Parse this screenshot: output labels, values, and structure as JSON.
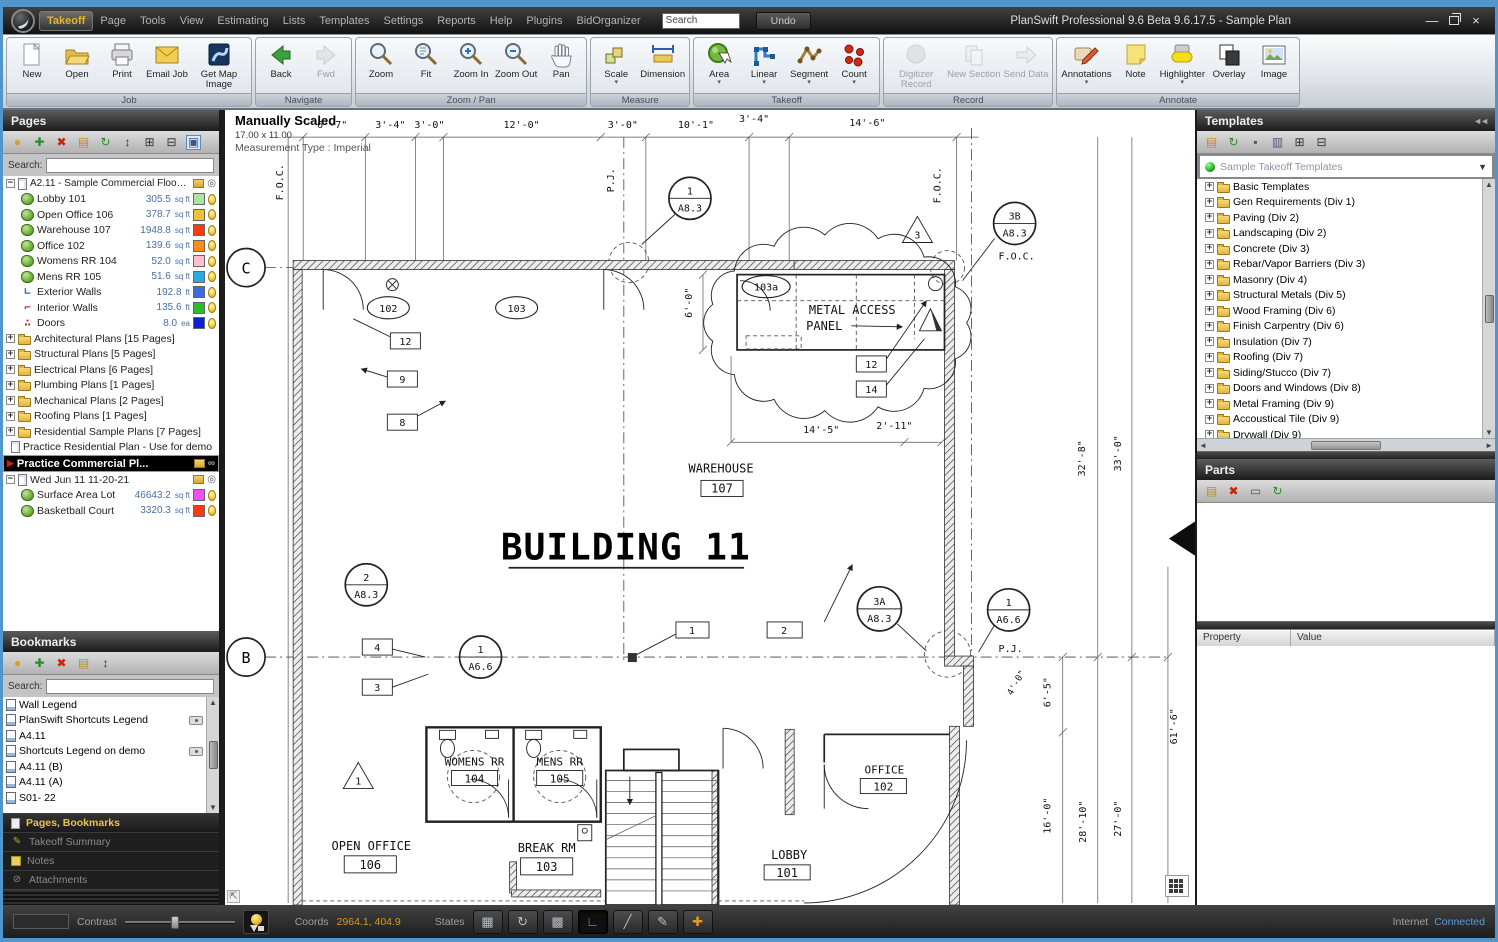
{
  "colors": {
    "accent_blue": "#4e96cc",
    "menu_gold": "#e5b42e",
    "coords_yellow": "#d89a1e",
    "connected_blue": "#5a9ae0"
  },
  "titlebar": {
    "menus": [
      "Takeoff",
      "Page",
      "Tools",
      "View",
      "Estimating",
      "Lists",
      "Templates",
      "Settings",
      "Reports",
      "Help",
      "Plugins",
      "BidOrganizer"
    ],
    "search_value": "Search",
    "undo": "Undo",
    "title": "PlanSwift Professional 9.6 Beta  9.6.17.5 - Sample Plan"
  },
  "ribbon": {
    "groups": [
      {
        "label": "Job",
        "buttons": [
          {
            "label": "New",
            "icon": "new-document-icon"
          },
          {
            "label": "Open",
            "icon": "open-folder-icon"
          },
          {
            "label": "Print",
            "icon": "print-icon"
          },
          {
            "label": "Email Job",
            "icon": "email-job-icon"
          },
          {
            "label": "Get Map Image",
            "icon": "get-map-image-icon"
          }
        ]
      },
      {
        "label": "Navigate",
        "buttons": [
          {
            "label": "Back",
            "icon": "back-icon"
          },
          {
            "label": "Fwd",
            "icon": "fwd-icon",
            "disabled": true
          }
        ]
      },
      {
        "label": "Zoom / Pan",
        "buttons": [
          {
            "label": "Zoom",
            "icon": "zoom-icon"
          },
          {
            "label": "Fit",
            "icon": "fit-icon"
          },
          {
            "label": "Zoom In",
            "icon": "zoom-in-icon"
          },
          {
            "label": "Zoom Out",
            "icon": "zoom-out-icon"
          },
          {
            "label": "Pan",
            "icon": "pan-icon"
          }
        ]
      },
      {
        "label": "Measure",
        "buttons": [
          {
            "label": "Scale",
            "icon": "scale-icon",
            "caret": true
          },
          {
            "label": "Dimension",
            "icon": "dimension-icon"
          }
        ]
      },
      {
        "label": "Takeoff",
        "buttons": [
          {
            "label": "Area",
            "icon": "area-icon",
            "caret": true
          },
          {
            "label": "Linear",
            "icon": "linear-icon",
            "caret": true
          },
          {
            "label": "Segment",
            "icon": "segment-icon",
            "caret": true
          },
          {
            "label": "Count",
            "icon": "count-icon",
            "caret": true
          }
        ]
      },
      {
        "label": "Record",
        "buttons": [
          {
            "label": "Digitizer Record",
            "icon": "digitizer-record-icon",
            "disabled": true
          },
          {
            "label": "New Section",
            "icon": "new-section-icon",
            "disabled": true
          },
          {
            "label": "Send Data",
            "icon": "send-data-icon",
            "disabled": true
          }
        ]
      },
      {
        "label": "Annotate",
        "buttons": [
          {
            "label": "Annotations",
            "icon": "annotations-icon",
            "caret": true
          },
          {
            "label": "Note",
            "icon": "note-icon"
          },
          {
            "label": "Highlighter",
            "icon": "highlighter-icon",
            "caret": true
          },
          {
            "label": "Overlay",
            "icon": "overlay-icon"
          },
          {
            "label": "Image",
            "icon": "image-icon"
          }
        ]
      }
    ]
  },
  "pages_panel": {
    "title": "Pages",
    "search_label": "Search:",
    "toolbar_icons": [
      "pin-icon",
      "add-icon",
      "delete-icon",
      "properties-icon",
      "refresh-icon",
      "sort-icon",
      "expand-all-icon",
      "collapse-all-icon",
      "panel-view-icon"
    ],
    "root_label": "A2.11 - Sample Commercial Floor Pl...",
    "takeoffs": [
      {
        "label": "Lobby 101",
        "value": "305.5",
        "unit": "sq ft",
        "color": "#abe49c",
        "icon": "area"
      },
      {
        "label": "Open Office 106",
        "value": "378.7",
        "unit": "sq ft",
        "color": "#f0c03a",
        "icon": "area"
      },
      {
        "label": "Warehouse 107",
        "value": "1948.8",
        "unit": "sq ft",
        "color": "#f93a10",
        "icon": "area"
      },
      {
        "label": "Office 102",
        "value": "139.6",
        "unit": "sq ft",
        "color": "#fb8c1e",
        "icon": "area"
      },
      {
        "label": "Womens RR 104",
        "value": "52.0",
        "unit": "sq ft",
        "color": "#ffc0cd",
        "icon": "area"
      },
      {
        "label": "Mens RR 105",
        "value": "51.6",
        "unit": "sq ft",
        "color": "#2eaae2",
        "icon": "area"
      },
      {
        "label": "Exterior Walls",
        "value": "192.8",
        "unit": "ft",
        "color": "#3d6be0",
        "icon": "linear-ext"
      },
      {
        "label": "Interior Walls",
        "value": "135.6",
        "unit": "ft",
        "color": "#2fbb2f",
        "icon": "linear-int"
      },
      {
        "label": "Doors",
        "value": "8.0",
        "unit": "ea",
        "color": "#1020d0",
        "icon": "count"
      }
    ],
    "folders": [
      "Architectural Plans [15 Pages]",
      "Structural Plans [5 Pages]",
      "Electrical Plans [6 Pages]",
      "Plumbing Plans [1 Pages]",
      "Mechanical Plans [2 Pages]",
      "Roofing Plans [1 Pages]",
      "Residential Sample Plans [7 Pages]"
    ],
    "practice_residential": "Practice Residential Plan - Use for demo",
    "selected_page": "Practice Commercial Pl...",
    "dated_page": "Wed Jun 11 11-20-21",
    "dated_takeoffs": [
      {
        "label": "Surface Area Lot",
        "value": "46643.2",
        "unit": "sq ft",
        "color": "#f24df2",
        "icon": "area"
      },
      {
        "label": "Basketball Court",
        "value": "3320.3",
        "unit": "sq ft",
        "color": "#f93a10",
        "icon": "area"
      }
    ]
  },
  "bookmarks_panel": {
    "title": "Bookmarks",
    "search_label": "Search:",
    "toolbar_icons": [
      "pin-icon",
      "add-icon",
      "delete-icon",
      "properties-icon",
      "sort-icon"
    ],
    "items": [
      {
        "label": "Wall Legend"
      },
      {
        "label": "PlanSwift Shortcuts Legend",
        "camera": true
      },
      {
        "label": "A4.11"
      },
      {
        "label": "Shortcuts Legend on demo",
        "camera": true
      },
      {
        "label": "A4.11 (B)"
      },
      {
        "label": "A4.11 (A)"
      },
      {
        "label": "S01- 22"
      }
    ]
  },
  "left_tabs": [
    {
      "label": "Pages, Bookmarks",
      "active": true,
      "icon": "pages-tab-icon"
    },
    {
      "label": "Takeoff Summary",
      "icon": "takeoff-summary-tab-icon"
    },
    {
      "label": "Notes",
      "icon": "notes-tab-icon"
    },
    {
      "label": "Attachments",
      "icon": "attachments-tab-icon"
    }
  ],
  "templates_panel": {
    "title": "Templates",
    "toolbar_icons": [
      "properties-icon",
      "refresh-icon",
      "new-template-icon",
      "copy-icon",
      "expand-all-icon",
      "collapse-all-icon"
    ],
    "dropdown": "Sample Takeoff Templates",
    "folders": [
      "Basic Templates",
      "Gen Requirements (Div 1)",
      "Paving (Div 2)",
      "Landscaping (Div 2)",
      "Concrete (Div 3)",
      "Rebar/Vapor Barriers (Div 3)",
      "Masonry (Div 4)",
      "Structural Metals (Div 5)",
      "Wood Framing (Div 6)",
      "Finish Carpentry (Div 6)",
      "Insulation (Div 7)",
      "Roofing (Div 7)",
      "Siding/Stucco (Div 7)",
      "Doors and Windows (Div 8)",
      "Metal Framing (Div 9)",
      "Accoustical Tile (Div 9)",
      "Drywall (Div 9)",
      "Flooring and Tile (Div 9)",
      "Paint (Div 9)",
      "Specialties (Div 10-14)",
      "Plumbing (Div 15)",
      "HVAC (Div 15)",
      "Electrical (Div 16)"
    ]
  },
  "parts_panel": {
    "title": "Parts",
    "toolbar_icons": [
      "properties-icon",
      "delete-icon",
      "card-icon",
      "refresh-icon"
    ],
    "property_col": "Property",
    "value_col": "Value"
  },
  "status_bar": {
    "contrast": "Contrast",
    "coords_label": "Coords",
    "coords_value": "2964.1, 404.9",
    "states_label": "States",
    "tool_icons": [
      "grid-snap-icon",
      "rotate-icon",
      "grid-icon",
      "takeoff-tool-icon",
      "dimension-tool-icon",
      "annotate-tool-icon",
      "crosshair-icon"
    ],
    "internet_label": "Internet",
    "internet_status": "Connected"
  },
  "canvas": {
    "scale_title": "Manually Scaled",
    "scale_dims": "17.00 x 11.00",
    "scale_type": "Measurement Type : Imperial",
    "building": "BUILDING 11",
    "metal_access_1": "METAL ACCESS",
    "metal_access_2": "PANEL",
    "grid_c": "C",
    "grid_b": "B",
    "foc": "F.O.C.",
    "pj": "P.J.",
    "top_dims": [
      "6'-7\"",
      "3'-4\"",
      "3'-0\"",
      "12'-0\"",
      "3'-0\"",
      "10'-1\"",
      "3'-4\"",
      "14'-6\""
    ],
    "dim_6_0": "6'-0\"",
    "dim_14_5": "14'-5\"",
    "dim_2_11": "2'-11\"",
    "right_dims": [
      "32'-8\"",
      "33'-0\"",
      "6'-5\"",
      "4'-0\"",
      "61'-6\"",
      "16'-0\"",
      "28'-10\"",
      "27'-0\""
    ],
    "rooms": [
      {
        "name": "WAREHOUSE",
        "num": "107"
      },
      {
        "name": "OPEN OFFICE",
        "num": "106"
      },
      {
        "name": "BREAK RM",
        "num": "103"
      },
      {
        "name": "WOMENS RR",
        "num": "104"
      },
      {
        "name": "MENS RR",
        "num": "105"
      },
      {
        "name": "OFFICE",
        "num": "102"
      },
      {
        "name": "LOBBY",
        "num": "101"
      }
    ],
    "bubbles": [
      {
        "t": "1",
        "b": "A8.3"
      },
      {
        "t": "3B",
        "b": "A8.3"
      },
      {
        "t": "2",
        "b": "A8.3"
      },
      {
        "t": "1",
        "b": "A6.6"
      },
      {
        "t": "3A",
        "b": "A8.3"
      },
      {
        "t": "1",
        "b": "A6.6"
      }
    ],
    "ovals": [
      "102",
      "103",
      "103a"
    ],
    "tags": [
      "12",
      "9",
      "8",
      "12",
      "14",
      "4",
      "3",
      "1",
      "2"
    ],
    "triangles": [
      "3",
      "1"
    ]
  }
}
